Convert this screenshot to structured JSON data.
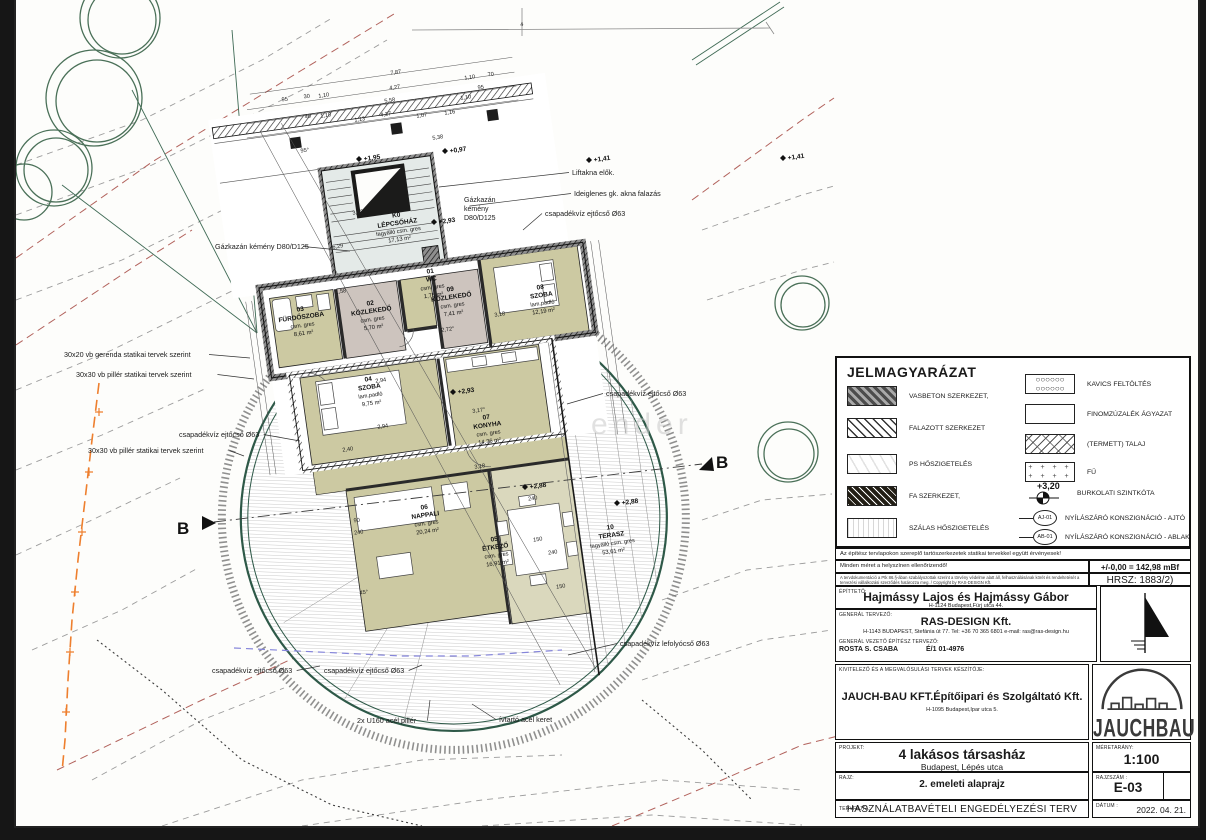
{
  "legend": {
    "title": "JELMAGYARÁZAT",
    "items_left": [
      {
        "label": "VASBETON SZERKEZET,",
        "pattern": "rebar"
      },
      {
        "label": "FALAZOTT SZERKEZET",
        "pattern": "masonry"
      },
      {
        "label": "PS HŐSZIGETELÉS",
        "pattern": "ps"
      },
      {
        "label": "FA SZERKEZET,",
        "pattern": "wood"
      },
      {
        "label": "SZÁLAS HŐSZIGETELÉS",
        "pattern": "fiber"
      }
    ],
    "items_right": [
      {
        "label": "KAVICS FELTÖLTÉS",
        "pattern": "gravel"
      },
      {
        "label": "FINOMZÚZALÉK ÁGYAZAT",
        "pattern": "plain"
      },
      {
        "label": "(TERMETT) TALAJ",
        "pattern": "soil"
      },
      {
        "label": "FŰ",
        "pattern": "grass"
      }
    ],
    "level_value": "+3,20",
    "level_label": "BURKOLATI SZINTKÓTA",
    "door_tag": "AJ-01",
    "door_label": "NYÍLÁSZÁRÓ KONSZIGNÁCIÓ - AJTÓ",
    "window_tag": "AB-01",
    "window_label": "NYÍLÁSZÁRÓ KONSZIGNÁCIÓ - ABLAK"
  },
  "notes": {
    "structural": "Az építész tervlapokon szereplő tartószerkezetek statikai tervekkel együtt érvényesek!",
    "measure": "Minden méret a helyszínen ellenőrizendő!",
    "datum": "+/-0,00 = 142,98 mBf",
    "copyright": "A tervdokumentáció a Ptk 86.§-ában szabályozottak szerint a törvény védelme alatt áll, felhasználásának körét és rendeltetését a tervezési vállalkozási szerződés határozza meg. / Copyright by RAS-DESIGN Kft.",
    "hrsz": "HRSZ: 1883/2)"
  },
  "title_block": {
    "client_label": "ÉPÍTTETŐ:",
    "client_name": "Hajmássy Lajos és Hajmássy Gábor",
    "client_address": "H-1124 Budapest,Fürj utca 44.",
    "designer_label": "GENERÁL TERVEZŐ:",
    "designer_name": "RAS-DESIGN Kft.",
    "designer_address": "H-1143 BUDAPEST, Stefánia út 77.  Tel: +36 70 365 6801  e-mail: ras@ras-design.hu",
    "chief_label": "GENERÁL VEZETŐ ÉPÍTÉSZ TERVEZŐ:",
    "chief_name": "ROSTA S. CSABA",
    "chief_license": "É/1 01-4976",
    "contractor_label": "KIVITELEZŐ ÉS A MEGVALÓSULÁSI TERVEK KÉSZÍTŐJE:",
    "contractor_name": "JAUCH-BAU KFT.Építőipari és Szolgáltató Kft.",
    "contractor_address": "H-1095 Budapest,Ipar utca 5.",
    "logo_text": "JAUCHBAU",
    "project_label": "PROJEKT:",
    "project_name": "4 lakásos társasház",
    "project_address": "Budapest, Lépés utca",
    "scale_label": "MÉRETARÁNY:",
    "scale": "1:100",
    "drawing_label": "RAJZ:",
    "drawing_name": "2. emeleti alaprajz",
    "number_label": "RAJZSZÁM :",
    "number": "E-03",
    "type_label": "TERVFAJTA:",
    "type": "HASZNÁLATBAVÉTELI ENGEDÉLYEZÉSI TERV",
    "date_label": "DÁTUM :",
    "date": "2022. 04. 21."
  },
  "plan": {
    "section_marker": "B",
    "watermark": "ender",
    "rooms": [
      {
        "num": "K0",
        "name": "LÉPCSŐHÁZ",
        "floor": "fagyálló csm. gres",
        "area": "17,13 m²",
        "x": 396,
        "y": 228
      },
      {
        "num": "01",
        "name": "WC",
        "floor": "csm. gres",
        "area": "1,75 m²",
        "x": 430,
        "y": 284
      },
      {
        "num": "02",
        "name": "KÖZLEKEDŐ",
        "floor": "csm. gres",
        "area": "5,70 m²",
        "x": 370,
        "y": 316
      },
      {
        "num": "03",
        "name": "FÜRDŐSZOBA",
        "floor": "csm. gres",
        "area": "8,61 m²",
        "x": 300,
        "y": 322
      },
      {
        "num": "04",
        "name": "SZOBA",
        "floor": "lam.padló",
        "area": "9,75 m²",
        "x": 368,
        "y": 392
      },
      {
        "num": "05",
        "name": "ÉTKEZŐ",
        "floor": "csm. gres",
        "area": "16,91 m²",
        "x": 494,
        "y": 552
      },
      {
        "num": "06",
        "name": "NAPPALI",
        "floor": "csm. gres",
        "area": "20,24 m²",
        "x": 424,
        "y": 520
      },
      {
        "num": "07",
        "name": "KONYHA",
        "floor": "csm. gres",
        "area": "14,36 m²",
        "x": 486,
        "y": 430
      },
      {
        "num": "08",
        "name": "SZOBA",
        "floor": "lam.padló",
        "area": "12,19 m²",
        "x": 540,
        "y": 300
      },
      {
        "num": "09",
        "name": "KÖZLEKEDŐ",
        "floor": "csm. gres",
        "area": "7,41 m²",
        "x": 450,
        "y": 302
      },
      {
        "num": "10",
        "name": "TERASZ",
        "floor": "fagyálló csm. gres",
        "area": "53,61 m²",
        "x": 610,
        "y": 540
      }
    ],
    "annotations": [
      {
        "t": "Liftakna elők.",
        "x": 570,
        "y": 175,
        "px": 437,
        "py": 187
      },
      {
        "t": "Ideiglenes gk. akna falazás",
        "x": 572,
        "y": 196,
        "px": 468,
        "py": 206
      },
      {
        "t": "Gázkazán kémény D80/D125",
        "x": 213,
        "y": 249,
        "px": 348,
        "py": 251
      },
      {
        "t": "csapadékvíz ejtőcső Ø63",
        "x": 543,
        "y": 216,
        "px": 521,
        "py": 230
      },
      {
        "t": "csapadékvíz ejtőcső Ø63",
        "x": 604,
        "y": 396,
        "px": 565,
        "py": 404
      },
      {
        "t": "csapadékvíz ejtőcső Ø63",
        "x": 177,
        "y": 437,
        "px": 298,
        "py": 441
      },
      {
        "t": "30x20 vb gerenda statikai tervek szerint",
        "x": 62,
        "y": 357,
        "px": 248,
        "py": 358
      },
      {
        "t": "30x30 vb pillér statikai tervek szerint",
        "x": 74,
        "y": 377,
        "px": 252,
        "py": 379
      },
      {
        "t": "30x30 vb pillér statikai tervek szerint",
        "x": 86,
        "y": 453,
        "px": 242,
        "py": 456
      },
      {
        "t": "csapadékvíz ejtőcső Ø63",
        "x": 210,
        "y": 673,
        "px": 318,
        "py": 666
      },
      {
        "t": "csapadékvíz ejtőcső Ø63",
        "x": 322,
        "y": 673,
        "px": 420,
        "py": 665
      },
      {
        "t": "csapadékvíz lefolyócső Ø63",
        "x": 618,
        "y": 646,
        "px": 566,
        "py": 655
      },
      {
        "t": "2x U160 acél pillér",
        "x": 355,
        "y": 723,
        "px": 428,
        "py": 700
      },
      {
        "t": "ívtartó acél keret",
        "x": 497,
        "y": 722,
        "px": 470,
        "py": 704
      }
    ],
    "chimney_note": [
      "Gázkazán",
      "kémény",
      "D80/D125"
    ],
    "dimensions": [
      {
        "t": "7,87",
        "x": 394,
        "y": 74
      },
      {
        "t": "4,27",
        "x": 393,
        "y": 89
      },
      {
        "t": "5,58",
        "x": 388,
        "y": 102
      },
      {
        "t": "4,27",
        "x": 384,
        "y": 116
      },
      {
        "t": "1,10",
        "x": 468,
        "y": 79
      },
      {
        "t": "70",
        "x": 489,
        "y": 76
      },
      {
        "t": "95",
        "x": 479,
        "y": 89
      },
      {
        "t": "1,10",
        "x": 464,
        "y": 99
      },
      {
        "t": "30",
        "x": 305,
        "y": 98
      },
      {
        "t": "1,10",
        "x": 322,
        "y": 97
      },
      {
        "t": "95",
        "x": 283,
        "y": 101
      },
      {
        "t": "40",
        "x": 306,
        "y": 118
      },
      {
        "t": "1,10",
        "x": 324,
        "y": 117
      },
      {
        "t": "1,13",
        "x": 358,
        "y": 121
      },
      {
        "t": "1,07",
        "x": 420,
        "y": 117
      },
      {
        "t": "1,16",
        "x": 448,
        "y": 114
      },
      {
        "t": "5,38",
        "x": 436,
        "y": 139
      },
      {
        "t": "95°",
        "x": 303,
        "y": 152
      },
      {
        "t": "4",
        "x": 520,
        "y": 26
      },
      {
        "t": "3,62",
        "x": 356,
        "y": 214
      },
      {
        "t": "6,29",
        "x": 336,
        "y": 248
      },
      {
        "t": "2,94",
        "x": 379,
        "y": 382
      },
      {
        "t": "2,94",
        "x": 381,
        "y": 428
      },
      {
        "t": "2,40",
        "x": 346,
        "y": 451
      },
      {
        "t": "3,17°",
        "x": 477,
        "y": 412
      },
      {
        "t": "3,18",
        "x": 478,
        "y": 468
      },
      {
        "t": "2,72°",
        "x": 446,
        "y": 331
      },
      {
        "t": "1,58",
        "x": 339,
        "y": 293
      },
      {
        "t": "3,18",
        "x": 498,
        "y": 316
      },
      {
        "t": "240",
        "x": 357,
        "y": 534
      },
      {
        "t": "90",
        "x": 355,
        "y": 522
      },
      {
        "t": "240",
        "x": 531,
        "y": 500
      },
      {
        "t": "150",
        "x": 536,
        "y": 541
      },
      {
        "t": "240",
        "x": 551,
        "y": 554
      },
      {
        "t": "150",
        "x": 559,
        "y": 588
      },
      {
        "t": "45°",
        "x": 362,
        "y": 594
      }
    ],
    "levels": [
      {
        "t": "+0,97",
        "x": 448,
        "y": 153
      },
      {
        "t": "+1,95",
        "x": 362,
        "y": 161
      },
      {
        "t": "+2,93",
        "x": 437,
        "y": 224
      },
      {
        "t": "+2,93",
        "x": 456,
        "y": 394
      },
      {
        "t": "+2,88",
        "x": 620,
        "y": 505
      },
      {
        "t": "+2,88",
        "x": 528,
        "y": 489
      },
      {
        "t": "+1,41",
        "x": 592,
        "y": 162
      },
      {
        "t": "+1,41",
        "x": 786,
        "y": 160
      }
    ]
  }
}
